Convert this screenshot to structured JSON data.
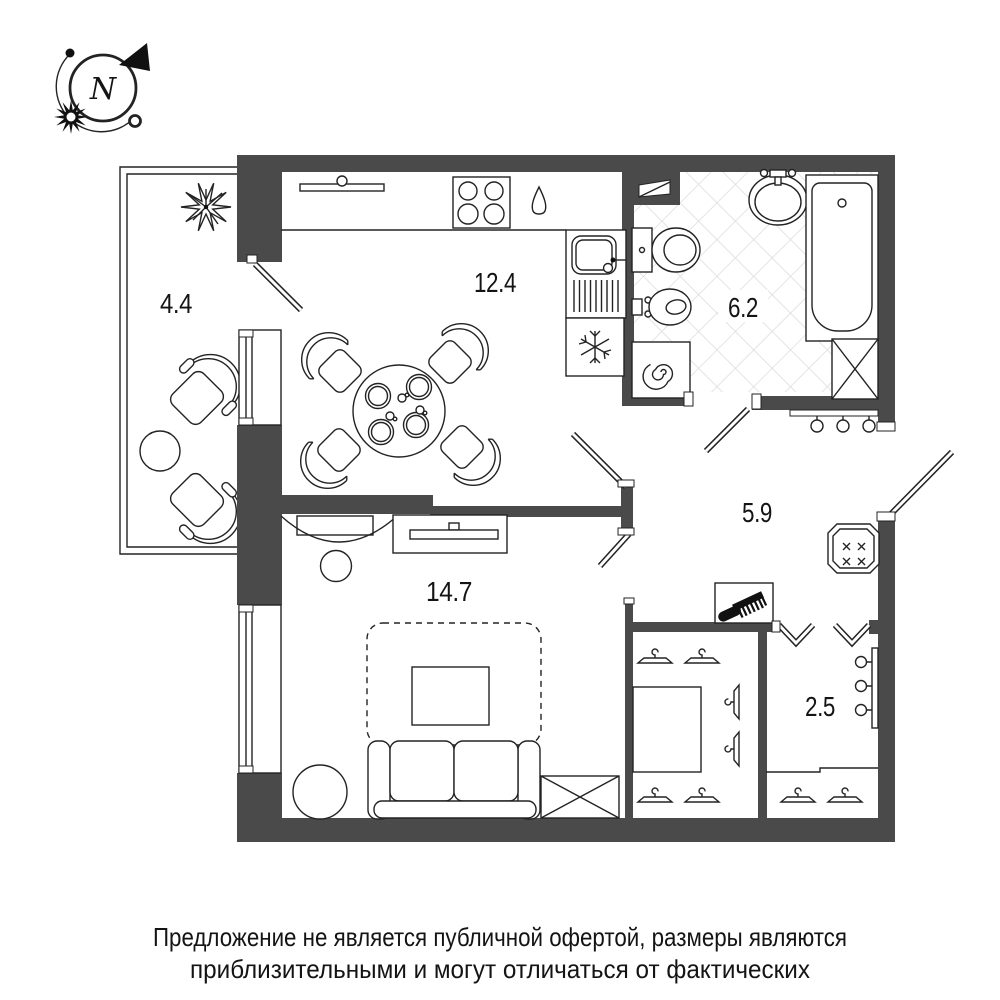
{
  "title": "apartment-floor-plan",
  "compass": {
    "letter": "N"
  },
  "rooms": [
    {
      "id": "balcony",
      "area": "4.4"
    },
    {
      "id": "kitchen-dining",
      "area": "12.4"
    },
    {
      "id": "bathroom",
      "area": "6.2"
    },
    {
      "id": "hallway",
      "area": "5.9"
    },
    {
      "id": "living-room",
      "area": "14.7"
    },
    {
      "id": "wardrobe",
      "area": "2.5"
    }
  ],
  "disclaimer": {
    "line1": "Предложение не является публичной офертой, размеры являются",
    "line2": "приблизительными и могут отличаться от фактических"
  },
  "colors": {
    "wall": "#4a4a4a",
    "line": "#232323",
    "hatch": "#dadada",
    "background": "#ffffff",
    "text": "#141414"
  },
  "icons": {
    "compass": "compass-rose-icon",
    "plant": "plant-icon",
    "stove": "stove-burners-icon",
    "water": "water-drop-icon",
    "sink": "kitchen-sink-icon",
    "fridge": "snowflake-fridge-icon",
    "toilet": "toilet-icon",
    "bidet": "bidet-icon",
    "washer": "washing-machine-spiral-icon",
    "basin": "washbasin-icon",
    "bathtub": "bathtub-icon",
    "shaft": "ventilation-shaft-icon",
    "towel": "towel-hooks-icon",
    "panel": "electrical-panel-icon",
    "comb": "comb-icon",
    "hanger": "clothes-hanger-icon",
    "hooks": "wall-hooks-icon",
    "sofa": "sofa-icon",
    "tv": "tv-console-icon",
    "rug": "rug-icon",
    "door": "door-leaf-icon",
    "bifold": "bifold-door-icon",
    "window": "window-icon"
  }
}
